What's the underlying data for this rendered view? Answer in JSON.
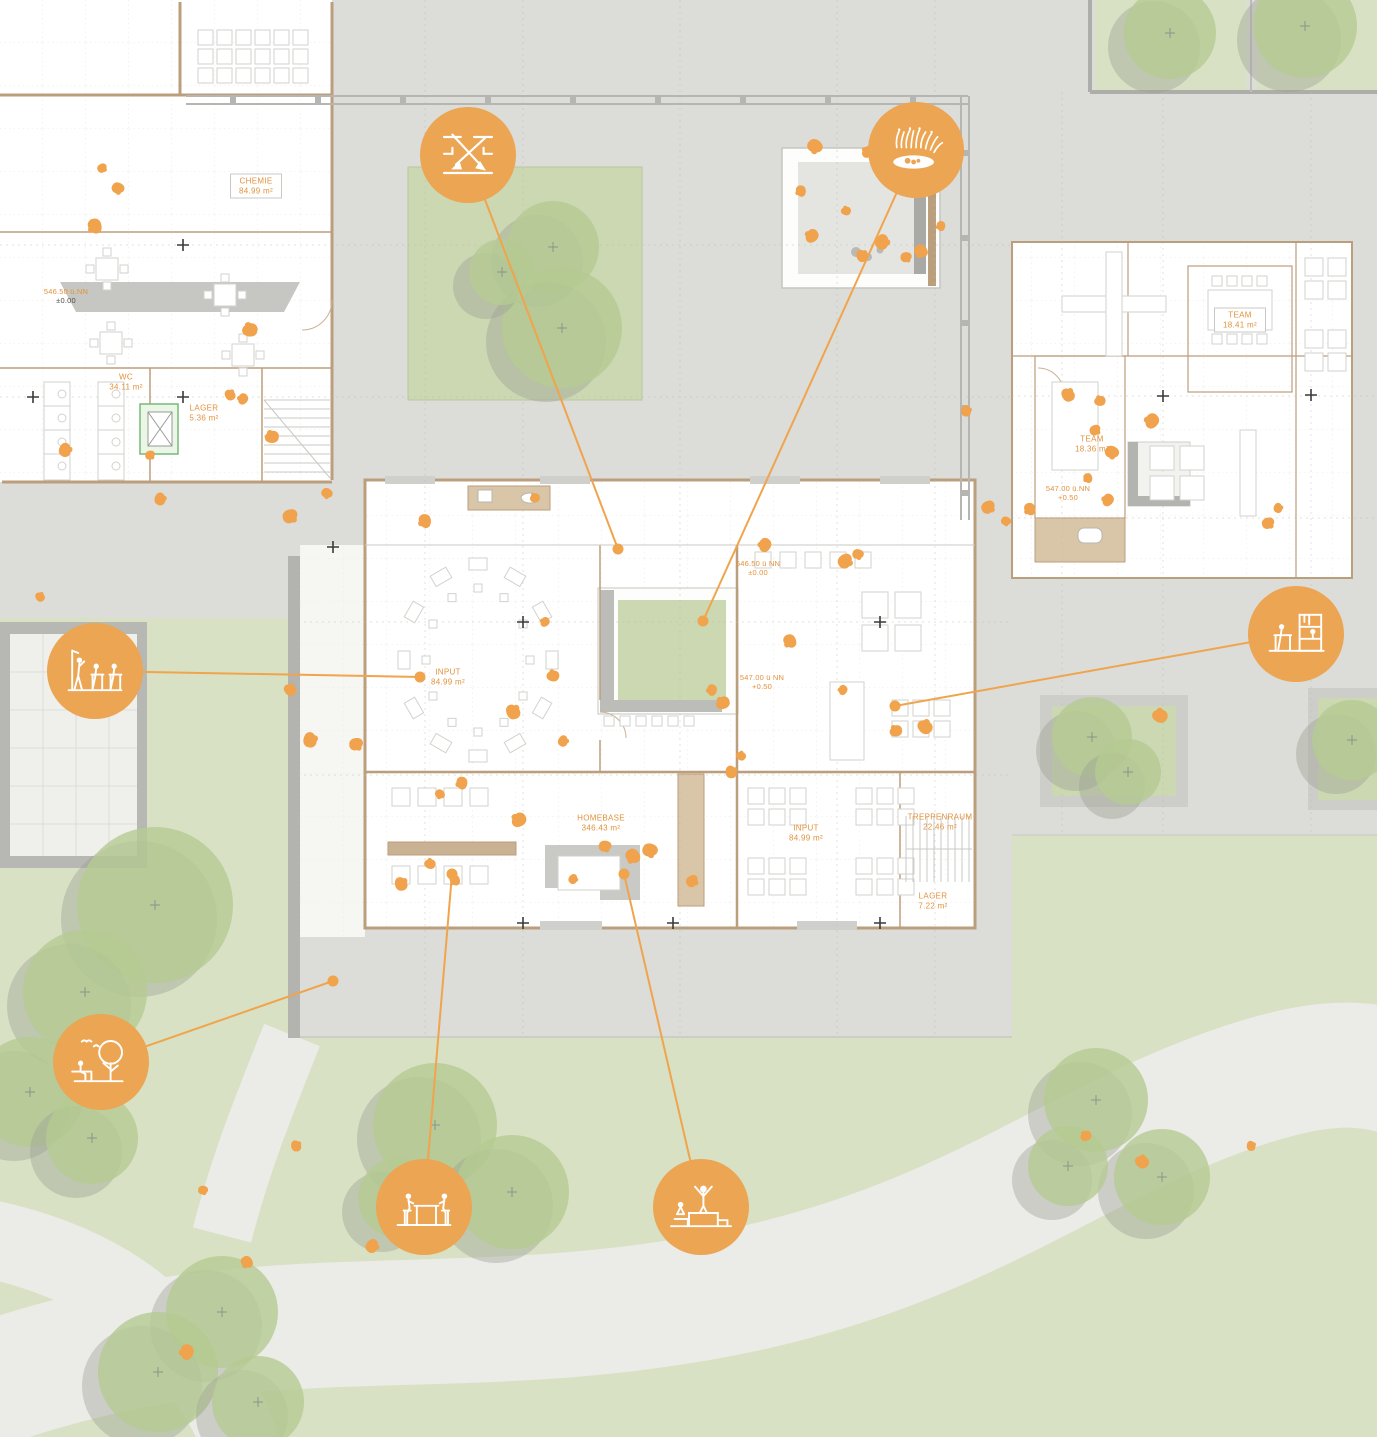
{
  "meta": {
    "title": "Erdgeschoss Lage- und Grundrissplan"
  },
  "colors": {
    "accent_orange": "#eba553",
    "leader_orange": "#f0a44c",
    "label_orange": "#e2923c",
    "plaza_gray": "#dcdcd8",
    "lawn_green": "#d8e1c3",
    "courtyard_green": "#cbd8b1",
    "tree_green": "#b5cb92",
    "wall_brown": "#bb9e7c",
    "path_gray": "#ebebe8"
  },
  "rooms": [
    {
      "name": "CHEMIE",
      "area": "84.99 m²"
    },
    {
      "name": "WC",
      "area": "34.11 m²"
    },
    {
      "name": "LAGER",
      "area": "5.36 m²"
    },
    {
      "name": "TEAM",
      "area": "18.41 m²"
    },
    {
      "name": "TEAM",
      "area": "18.36 m²"
    },
    {
      "name": "INPUT",
      "area": "84.99 m²"
    },
    {
      "name": "HOMEBASE",
      "area": "346.43 m²"
    },
    {
      "name": "INPUT",
      "area": "84.99 m²"
    },
    {
      "name": "TREPPENRAUM",
      "area": "22.46 m²"
    },
    {
      "name": "LAGER",
      "area": "7.22 m²"
    }
  ],
  "elevations": [
    {
      "level": "546.50 ü.NN",
      "offset": "±0.00"
    },
    {
      "level": "546.50 ü NN",
      "offset": "±0.00"
    },
    {
      "level": "547.00 ü NN",
      "offset": "+0.50"
    },
    {
      "level": "547.00 ü.NN",
      "offset": "+0.50"
    }
  ],
  "icons": [
    {
      "name": "circulation-arrows-icon"
    },
    {
      "name": "garden-pond-icon"
    },
    {
      "name": "classroom-icon"
    },
    {
      "name": "furniture-shelf-icon"
    },
    {
      "name": "tree-bench-icon"
    },
    {
      "name": "picnic-table-icon"
    },
    {
      "name": "podium-icon"
    }
  ],
  "decor": {
    "trees": [
      [
        155,
        905,
        78
      ],
      [
        85,
        992,
        62
      ],
      [
        30,
        1092,
        55
      ],
      [
        92,
        1138,
        46
      ],
      [
        222,
        1312,
        56
      ],
      [
        158,
        1372,
        60
      ],
      [
        258,
        1402,
        46
      ],
      [
        435,
        1125,
        62
      ],
      [
        512,
        1192,
        57
      ],
      [
        398,
        1198,
        40
      ],
      [
        1096,
        1100,
        52
      ],
      [
        1162,
        1177,
        48
      ],
      [
        1068,
        1166,
        40
      ],
      [
        1170,
        33,
        46
      ],
      [
        1305,
        26,
        52
      ],
      [
        553,
        247,
        46
      ],
      [
        562,
        328,
        60
      ],
      [
        502,
        272,
        33
      ],
      [
        1092,
        737,
        40
      ],
      [
        1128,
        772,
        33
      ],
      [
        1352,
        740,
        40
      ]
    ],
    "leaves": [
      [
        102,
        168
      ],
      [
        118,
        188
      ],
      [
        95,
        226
      ],
      [
        243,
        399
      ],
      [
        272,
        437
      ],
      [
        40,
        597
      ],
      [
        160,
        499
      ],
      [
        290,
        516
      ],
      [
        327,
        493
      ],
      [
        425,
        521
      ],
      [
        545,
        622
      ],
      [
        553,
        676
      ],
      [
        513,
        712
      ],
      [
        563,
        741
      ],
      [
        356,
        744
      ],
      [
        440,
        794
      ],
      [
        462,
        783
      ],
      [
        519,
        820
      ],
      [
        430,
        864
      ],
      [
        401,
        884
      ],
      [
        573,
        879
      ],
      [
        605,
        846
      ],
      [
        633,
        856
      ],
      [
        712,
        690
      ],
      [
        723,
        703
      ],
      [
        741,
        756
      ],
      [
        731,
        772
      ],
      [
        845,
        561
      ],
      [
        858,
        554
      ],
      [
        790,
        641
      ],
      [
        843,
        690
      ],
      [
        896,
        731
      ],
      [
        925,
        727
      ],
      [
        966,
        411
      ],
      [
        988,
        507
      ],
      [
        1006,
        521
      ],
      [
        1030,
        509
      ],
      [
        1152,
        421
      ],
      [
        1100,
        401
      ],
      [
        1068,
        395
      ],
      [
        1278,
        508
      ],
      [
        1268,
        523
      ],
      [
        815,
        146
      ],
      [
        801,
        191
      ],
      [
        812,
        236
      ],
      [
        846,
        211
      ],
      [
        862,
        256
      ],
      [
        882,
        242
      ],
      [
        906,
        257
      ],
      [
        921,
        251
      ],
      [
        941,
        226
      ],
      [
        868,
        152
      ],
      [
        1160,
        716
      ],
      [
        296,
        1146
      ],
      [
        372,
        1246
      ],
      [
        203,
        1190
      ],
      [
        247,
        1262
      ],
      [
        187,
        1352
      ],
      [
        1086,
        1136
      ],
      [
        1142,
        1162
      ],
      [
        1251,
        1146
      ],
      [
        692,
        881
      ],
      [
        650,
        850
      ],
      [
        455,
        880
      ],
      [
        765,
        545
      ],
      [
        535,
        498
      ],
      [
        290,
        690
      ],
      [
        310,
        740
      ],
      [
        1095,
        430
      ],
      [
        1112,
        452
      ],
      [
        1088,
        478
      ],
      [
        1108,
        500
      ],
      [
        250,
        330
      ],
      [
        230,
        395
      ],
      [
        65,
        450
      ],
      [
        150,
        455
      ]
    ]
  }
}
